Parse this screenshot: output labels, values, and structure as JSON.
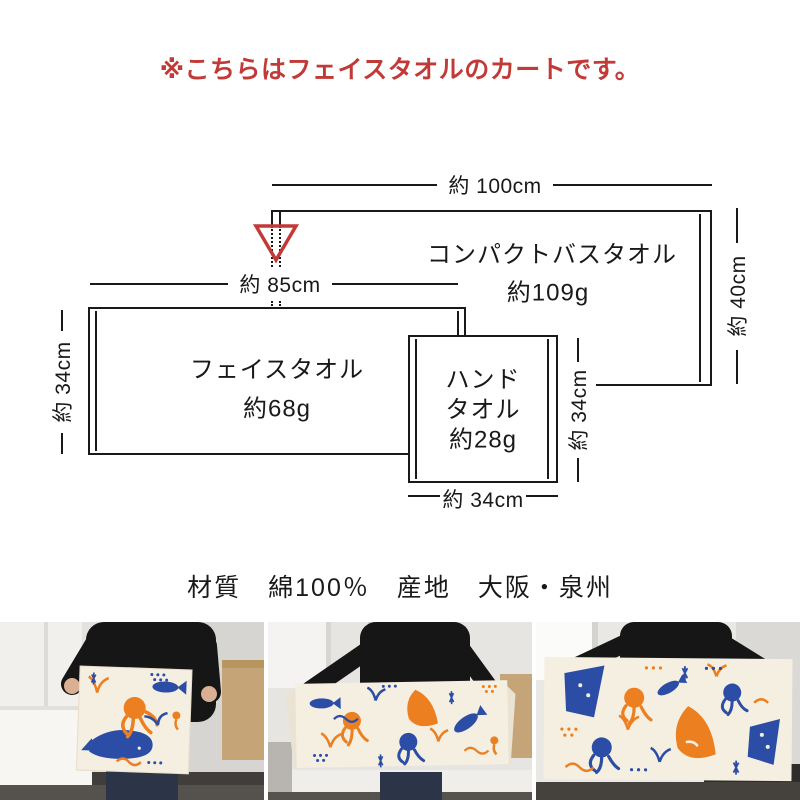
{
  "notice": {
    "text": "※こちらはフェイスタオルのカートです。"
  },
  "colors": {
    "accent_red": "#c23a38",
    "line": "#191919",
    "towel_orange": "#ec7f1f",
    "towel_blue": "#2b4da6",
    "cloth": "#f5efe2"
  },
  "diagram": {
    "compact": {
      "name": "コンパクトバスタオル",
      "weight": "約109g",
      "width_label": "約 100cm",
      "height_label": "約 40cm"
    },
    "face": {
      "name": "フェイスタオル",
      "weight": "約68g",
      "width_label": "約 85cm",
      "height_label": "約 34cm"
    },
    "hand": {
      "name_line1": "ハンド",
      "name_line2": "タオル",
      "weight": "約28g",
      "width_label": "約 34cm",
      "height_label": "約 34cm"
    },
    "marker": {
      "shape": "inverted-triangle-outline"
    }
  },
  "specs": {
    "text": "材質　綿100％　産地　大阪・泉州"
  },
  "photos": [
    {
      "name": "towel-held-folded-square"
    },
    {
      "name": "towel-held-spread-long"
    },
    {
      "name": "towel-held-wide-closeup"
    }
  ]
}
